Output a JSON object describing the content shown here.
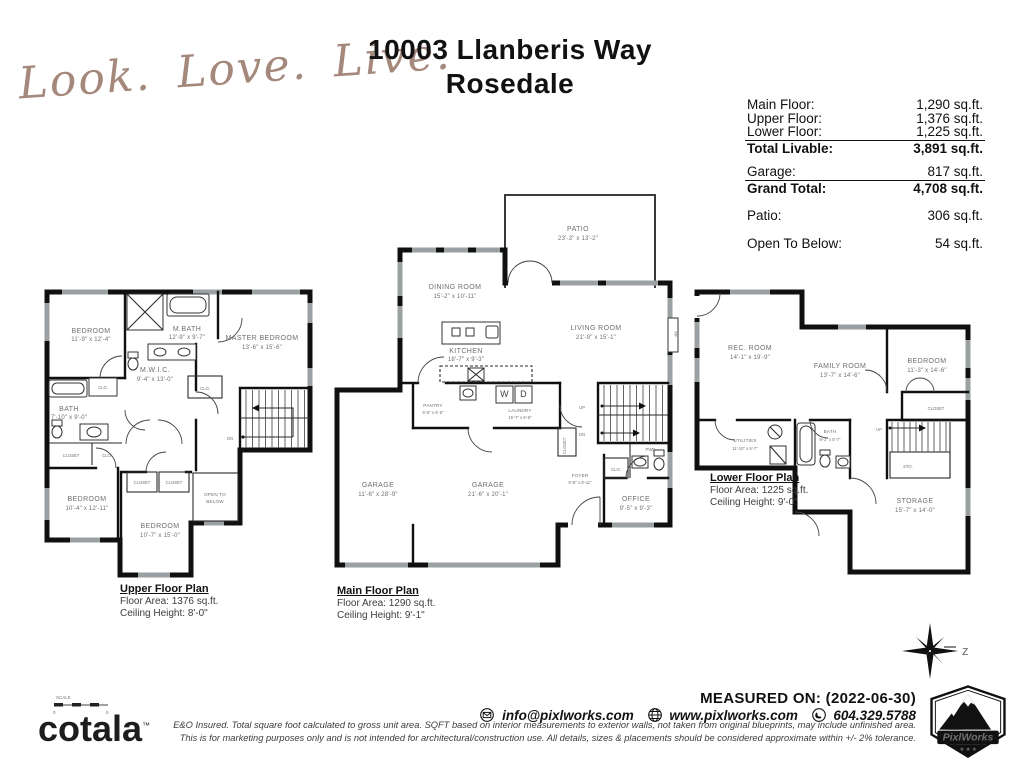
{
  "header": {
    "script": {
      "w1": "Look.",
      "w2": "Love.",
      "w3": "Live."
    },
    "title1": "10003 Llanberis Way",
    "title2": "Rosedale"
  },
  "summary": {
    "main_floor": {
      "label": "Main Floor:",
      "value": "1,290 sq.ft."
    },
    "upper_floor": {
      "label": "Upper Floor:",
      "value": "1,376 sq.ft."
    },
    "lower_floor": {
      "label": "Lower Floor:",
      "value": "1,225 sq.ft."
    },
    "total_livable": {
      "label": "Total Livable:",
      "value": "3,891 sq.ft."
    },
    "garage": {
      "label": "Garage:",
      "value": "817 sq.ft."
    },
    "grand_total": {
      "label": "Grand Total:",
      "value": "4,708 sq.ft."
    },
    "patio": {
      "label": "Patio:",
      "value": "306 sq.ft."
    },
    "open_to_below": {
      "label": "Open To Below:",
      "value": "54 sq.ft."
    }
  },
  "upper": {
    "caption_title": "Upper Floor Plan",
    "caption_area": "Floor Area: 1376 sq.ft.",
    "caption_ceiling": "Ceiling Height: 8'-0\"",
    "bedroom1_name": "BEDROOM",
    "bedroom1_dims": "11'-9\" x 12'-4\"",
    "mbath_name": "M.BATH",
    "mbath_dims": "12'-9\" x 9'-7\"",
    "master_name": "MASTER BEDROOM",
    "master_dims": "13'-6\" x 15'-6\"",
    "mwic_name": "M.W.I.C.",
    "mwic_dims": "9'-4\" x 13'-0\"",
    "bath_name": "BATH",
    "bath_dims": "7'-10\" x 9'-0\"",
    "bedroom2_name": "BEDROOM",
    "bedroom2_dims": "10'-4\" x 12'-11\"",
    "bedroom3_name": "BEDROOM",
    "bedroom3_dims": "10'-7\" x 15'-0\"",
    "open1": "OPEN TO",
    "open2": "BELOW",
    "dn": "DN"
  },
  "main": {
    "caption_title": "Main Floor Plan",
    "caption_area": "Floor Area: 1290 sq.ft.",
    "caption_ceiling": "Ceiling Height: 9'-1\"",
    "patio_name": "PATIO",
    "patio_dims": "23'-3\" x 13'-2\"",
    "dining_name": "DINING ROOM",
    "dining_dims": "15'-2\" x 10'-11\"",
    "living_name": "LIVING ROOM",
    "living_dims": "21'-9\" x 15'-1\"",
    "kitchen_name": "KITCHEN",
    "kitchen_dims": "18'-7\" x 9'-3\"",
    "pantry_name": "PANTRY",
    "pantry_dims": "6'-5\" x 6'-5\"",
    "laundry_name": "LAUNDRY",
    "laundry_dims": "15'-7\" x 6'-5\"",
    "garage1_name": "GARAGE",
    "garage1_dims": "11'-6\" x 28'-9\"",
    "garage2_name": "GARAGE",
    "garage2_dims": "21'-6\" x 20'-1\"",
    "foyer_name": "FOYER",
    "foyer_dims": "6'-8\" x 6'-11\"",
    "office_name": "OFFICE",
    "office_dims": "9'-5\" x 9'-3\"",
    "pwd": "PWD.",
    "washer": "W",
    "dryer": "D",
    "fp": "FP",
    "up": "UP",
    "dn": "DN"
  },
  "lower": {
    "caption_title": "Lower Floor Plan",
    "caption_area": "Floor Area: 1225 sq.ft.",
    "caption_ceiling": "Ceiling Height: 9'-0\"",
    "rec_name": "REC. ROOM",
    "rec_dims": "14'-1\" x 19'-9\"",
    "family_name": "FAMILY ROOM",
    "family_dims": "13'-7\" x 14'-6\"",
    "bedroom_name": "BEDROOM",
    "bedroom_dims": "11'-3\" x 14'-6\"",
    "utilities_name": "UTILITIES",
    "utilities_dims": "11'-10\" x 5'-7\"",
    "bath_name": "BATH",
    "bath_dims": "9'-2\" x 5'-7\"",
    "storage_name": "STORAGE",
    "storage_dims": "15'-7\" x 14'-0\"",
    "sto": "STO.",
    "up": "UP"
  },
  "shared": {
    "clo": "CLO.",
    "closet": "CLOSET"
  },
  "compass": {
    "letter": "z"
  },
  "scalebar": {
    "label": "SCALE",
    "left": "0",
    "right": "5"
  },
  "footer": {
    "measured": "MEASURED ON: (2022-06-30)",
    "email": "info@pixlworks.com",
    "website": "www.pixlworks.com",
    "phone": "604.329.5788",
    "disclaimer1": "E&O Insured.  Total square foot calculated to gross unit area. SQFT based on interior measurements to exterior walls, not taken from original blueprints, may include unfinished area.",
    "disclaimer2": "This is for marketing purposes only and is not intended for architectural/construction use.  All details, sizes & placements should be considered approximate within +/- 2%  tolerance.",
    "cotala": "cotala",
    "tm": "™",
    "pixlworks": "PixlWorks",
    "stars": "★ ★ ★"
  }
}
